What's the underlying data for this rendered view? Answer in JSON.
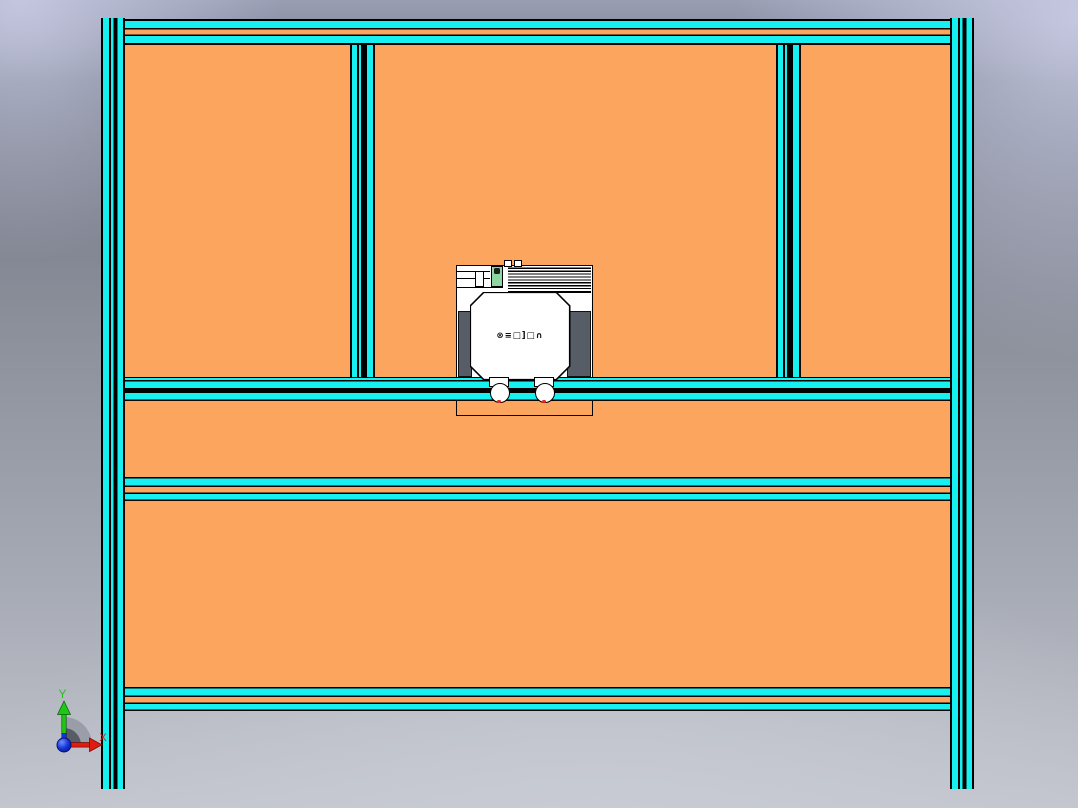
{
  "colors": {
    "cyan": "#16f0f0",
    "orange": "#fba55f",
    "panel_dark": "#575d66",
    "green_part": "#8ed6a2",
    "axis_x_red": "#e01b10",
    "axis_y_green": "#1fc715",
    "origin_blue": "#1535d8"
  },
  "triad": {
    "x_label": "X",
    "y_label": "Y"
  },
  "carriage": {
    "logo_text": "⊗≡□]□∩"
  }
}
